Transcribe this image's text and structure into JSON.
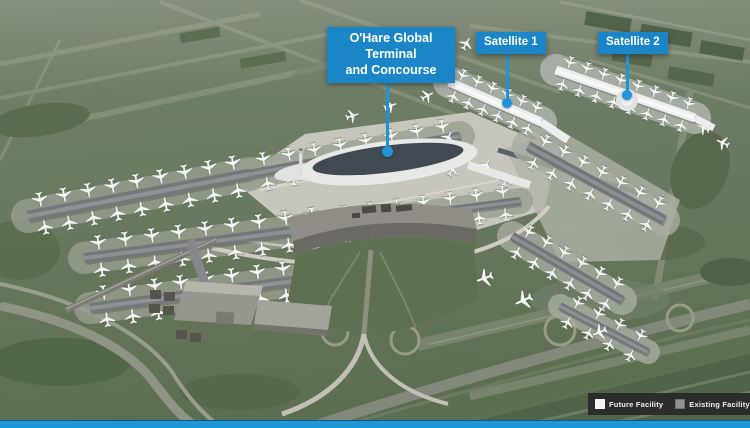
{
  "callouts": {
    "global_terminal": {
      "line1": "O'Hare Global Terminal",
      "line2": "and Concourse"
    },
    "satellite_1": {
      "label": "Satellite 1"
    },
    "satellite_2": {
      "label": "Satellite 2"
    }
  },
  "legend": {
    "future": {
      "label": "Future Facility"
    },
    "existing": {
      "label": "Existing Facility"
    }
  },
  "theme": {
    "accent-blue": "#1a86c8",
    "pointer-blue": "#2293d6",
    "legend-bg": "rgba(41,41,41,0.93)",
    "footer-blue": "#1e96d8",
    "future-swatch": "#f4f4f3",
    "existing-swatch": "#909294"
  }
}
